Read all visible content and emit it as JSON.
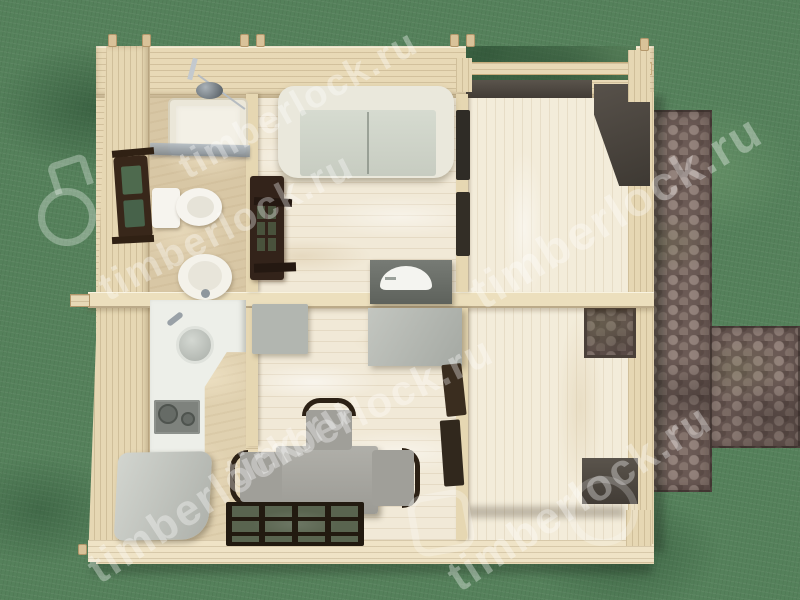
{
  "scene": {
    "description": "Top-down 3D render of a small timber cabin floor plan on a lawn with a cobblestone path",
    "watermark": {
      "text": "timberlock.ru",
      "brand": "timberlock"
    },
    "colors": {
      "grass": "#55815b",
      "path_stone": "#6b5a55",
      "timber_wall": "#e8d9b6",
      "whitewashed_floor": "#f1e9d7",
      "bathroom_floor": "#d8c7a5",
      "veranda_floor": "#f3ecda",
      "sofa_cushion": "#d2d7cb",
      "furniture_gray": "#a8a7a1",
      "dark_wood_joinery": "#33231a",
      "rug_frame": "#221a10",
      "white_fixtures": "#f4f2ea",
      "watermark": "rgba(255,255,255,0.34)"
    },
    "rooms": [
      {
        "name": "bathroom",
        "furniture": [
          "shower tray",
          "shower mixer",
          "toilet",
          "pedestal sink",
          "window"
        ]
      },
      {
        "name": "kitchen",
        "furniture": [
          "L-shaped counter",
          "round sink",
          "two-burner cooktop",
          "storage bench"
        ]
      },
      {
        "name": "living-room",
        "furniture": [
          "two-seat sofa",
          "tv cabinet",
          "tv"
        ]
      },
      {
        "name": "dining-room",
        "furniture": [
          "desk",
          "dining table",
          "three chairs",
          "slatted rug",
          "cabinet"
        ]
      },
      {
        "name": "veranda",
        "furniture": [
          "open roof beams",
          "wall openings",
          "corner posts"
        ]
      }
    ],
    "exterior": [
      "lawn",
      "cobblestone path"
    ]
  }
}
